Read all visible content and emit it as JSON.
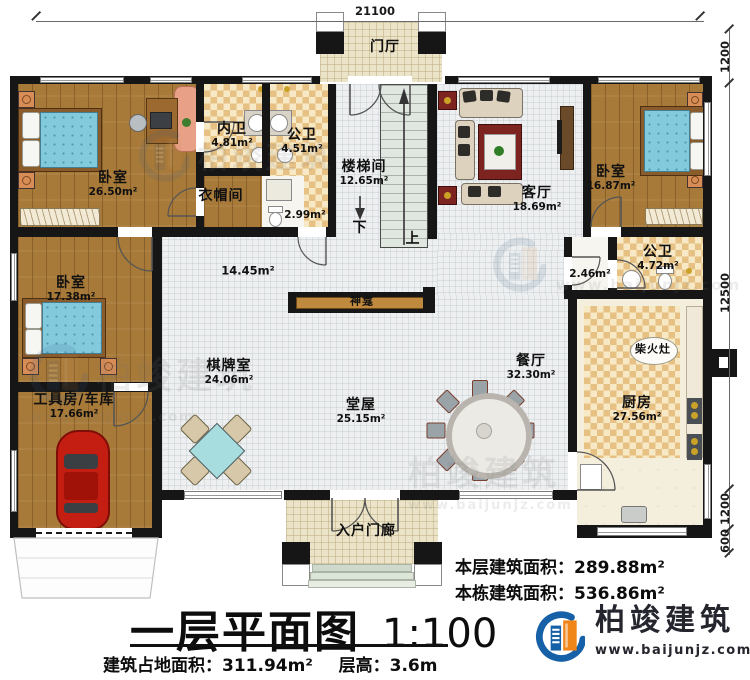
{
  "rooms": {
    "foyer": {
      "label": "门厅"
    },
    "bedroom_tl": {
      "label": "卧室",
      "area": "26.50m²"
    },
    "bath_inner": {
      "label": "内卫",
      "area": "4.81m²"
    },
    "bath_public_top": {
      "label": "公卫",
      "area": "4.51m²"
    },
    "cloakroom": {
      "label": "衣帽间"
    },
    "wc_small": {
      "area": "2.99m²"
    },
    "stairwell": {
      "label": "楼梯间",
      "area": "12.65m²"
    },
    "living": {
      "label": "客厅",
      "area": "18.69m²"
    },
    "bedroom_tr": {
      "label": "卧室",
      "area": "16.87m²"
    },
    "bedroom_ml": {
      "label": "卧室",
      "area": "17.38m²"
    },
    "corridor": {
      "area": "14.45m²"
    },
    "shrine": {
      "label": "神龛"
    },
    "chess": {
      "label": "棋牌室",
      "area": "24.06m²"
    },
    "main_hall": {
      "label": "堂屋",
      "area": "25.15m²"
    },
    "dining": {
      "label": "餐厅",
      "area": "32.30m²"
    },
    "bath_right": {
      "label": "公卫",
      "area": "4.72m²"
    },
    "lobby_small": {
      "area": "2.46m²"
    },
    "stove": {
      "label": "柴火灶"
    },
    "kitchen": {
      "label": "厨房",
      "area": "27.56m²"
    },
    "garage": {
      "label": "工具房/车库",
      "area": "17.66m²"
    },
    "porch": {
      "label": "入户门廊"
    }
  },
  "stairs": {
    "down": "下",
    "up": "上"
  },
  "dimensions": {
    "top_width": "21100",
    "right_foyer": "1200",
    "right_main": "12500",
    "right_porch": "1200",
    "right_steps": "600"
  },
  "title_block": {
    "title": "一层平面图",
    "scale": "1:100",
    "footprint_label": "建筑占地面积：",
    "footprint_value": "311.94m²",
    "height_label": "层高：",
    "height_value": "3.6m",
    "floor_area_label": "本层建筑面积：",
    "floor_area_value": "289.88m²",
    "building_area_label": "本栋建筑面积：",
    "building_area_value": "536.86m²"
  },
  "logo": {
    "name": "柏竣建筑",
    "website": "www.baijunjz.com"
  },
  "watermark": {
    "name": "柏竣建筑",
    "url": "www.baijunjz.com"
  },
  "colors": {
    "wall": "#161616",
    "wood_floor": "#a87a39",
    "checker": "#e7c083",
    "logo_blue": "#1660a8",
    "logo_orange": "#f08519",
    "bed_blue": "#84cadd"
  }
}
